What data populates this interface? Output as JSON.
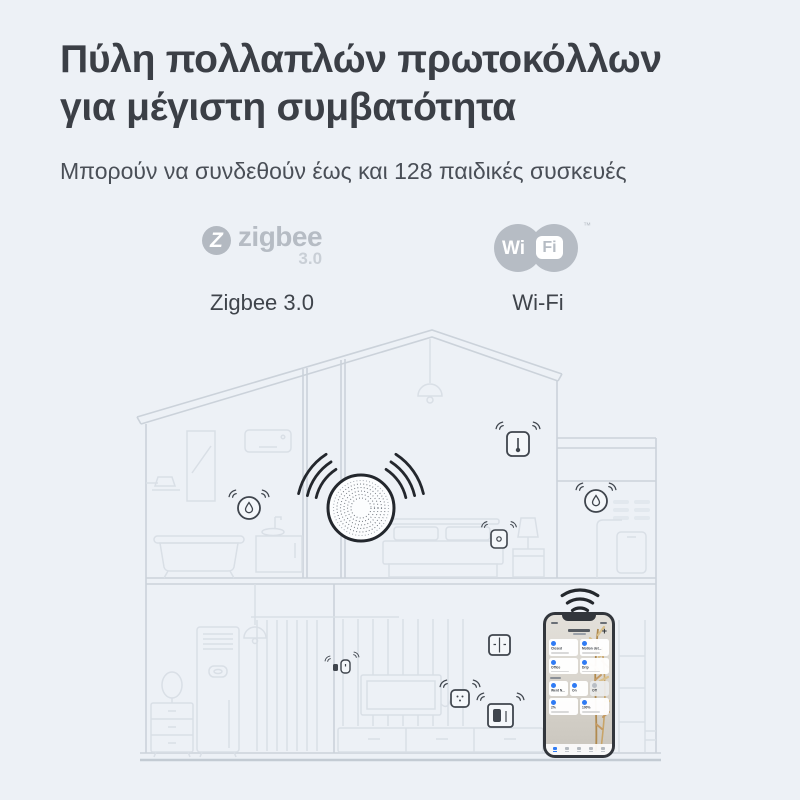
{
  "colors": {
    "background": "#edf1f6",
    "title_text": "#3b3f46",
    "subtitle_text": "#4a4f57",
    "logo_gray": "#b6bcc4",
    "wall_line": "#cbd2da",
    "furniture_line": "#d9dfe6",
    "device_line": "#3f454d",
    "hub_ring": "#23272d",
    "app_accent_blue": "#2f7bf4",
    "plant_tan": "#c49a63"
  },
  "header": {
    "title_line1": "Πύλη πολλαπλών πρωτοκόλλων",
    "title_line2": "για μέγιστη συμβατότητα",
    "subtitle": "Μπορούν να συνδεθούν έως και 128 παιδικές συσκευές"
  },
  "protocols": {
    "zigbee": {
      "icon_letter": "Z",
      "word": "zigbee",
      "version": "3.0",
      "label": "Zigbee 3.0"
    },
    "wifi": {
      "wi": "Wi",
      "fi": "Fi",
      "tm": "™",
      "label": "Wi-Fi"
    }
  },
  "illustration": {
    "description": "Two-storey house line drawing: central smart hub broadcasts to sensors in every room, smartphone app connected over Wi-Fi",
    "devices": [
      "smart-hub",
      "water-leak-sensor-bathroom",
      "water-leak-sensor-annex",
      "temperature-sensor-bedroom",
      "mini-sensor-bedroom",
      "mini-sensor-pair-livingroom",
      "motion-sensor-livingroom",
      "double-wall-switch",
      "smart-cube-device",
      "smartphone-with-app"
    ]
  },
  "phone_app": {
    "plus_icon": "+",
    "cards": [
      "Closed",
      "Motion det...",
      "Office",
      "Drip",
      "Went N...",
      "On",
      "Off",
      "2%",
      "100%"
    ]
  }
}
